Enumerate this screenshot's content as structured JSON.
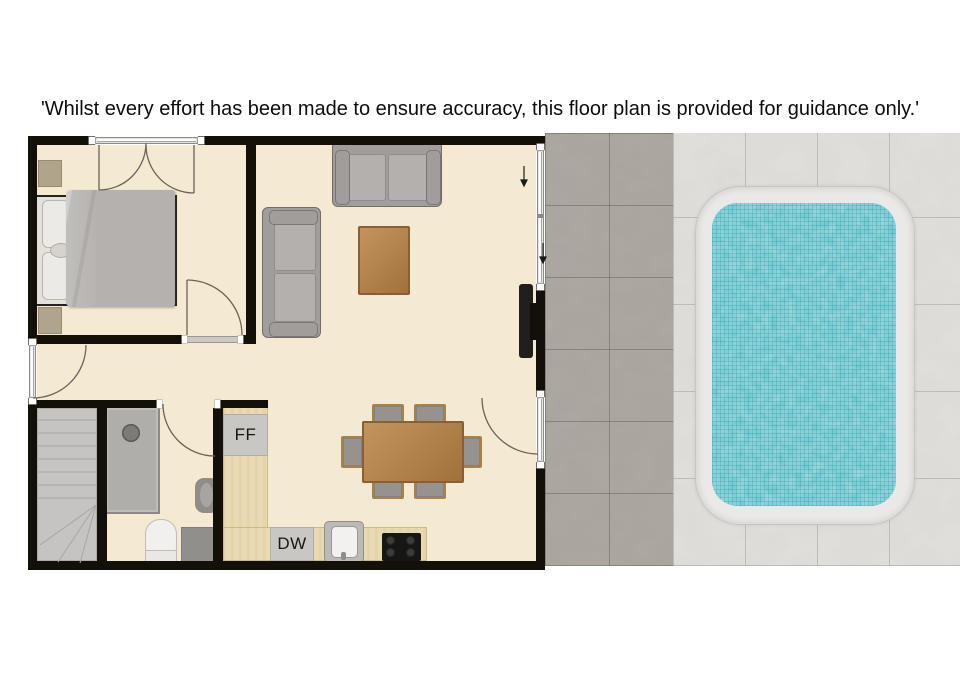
{
  "disclaimer": {
    "text": "'Whilst every effort has been made to ensure accuracy, this floor plan is provided for guidance only.'"
  },
  "labels": {
    "fridge_freezer": "FF",
    "dishwasher": "DW"
  },
  "colors": {
    "floor": "#f4ead1",
    "wall": "#121009",
    "counter": "#e9dab2",
    "wood": "#b5854f",
    "wood_dark": "#8a5f33",
    "sofa_body": "#a09d9a",
    "sofa_cushion": "#b3b0ad",
    "appliance_box": "#c9c7c4",
    "blanket": "#b4b1ae",
    "pool_water": "#5fc0ca",
    "pool_coping": "#ebe9e7",
    "tile_dark": "#a9a59d",
    "tile_light": "#dcdad6"
  }
}
